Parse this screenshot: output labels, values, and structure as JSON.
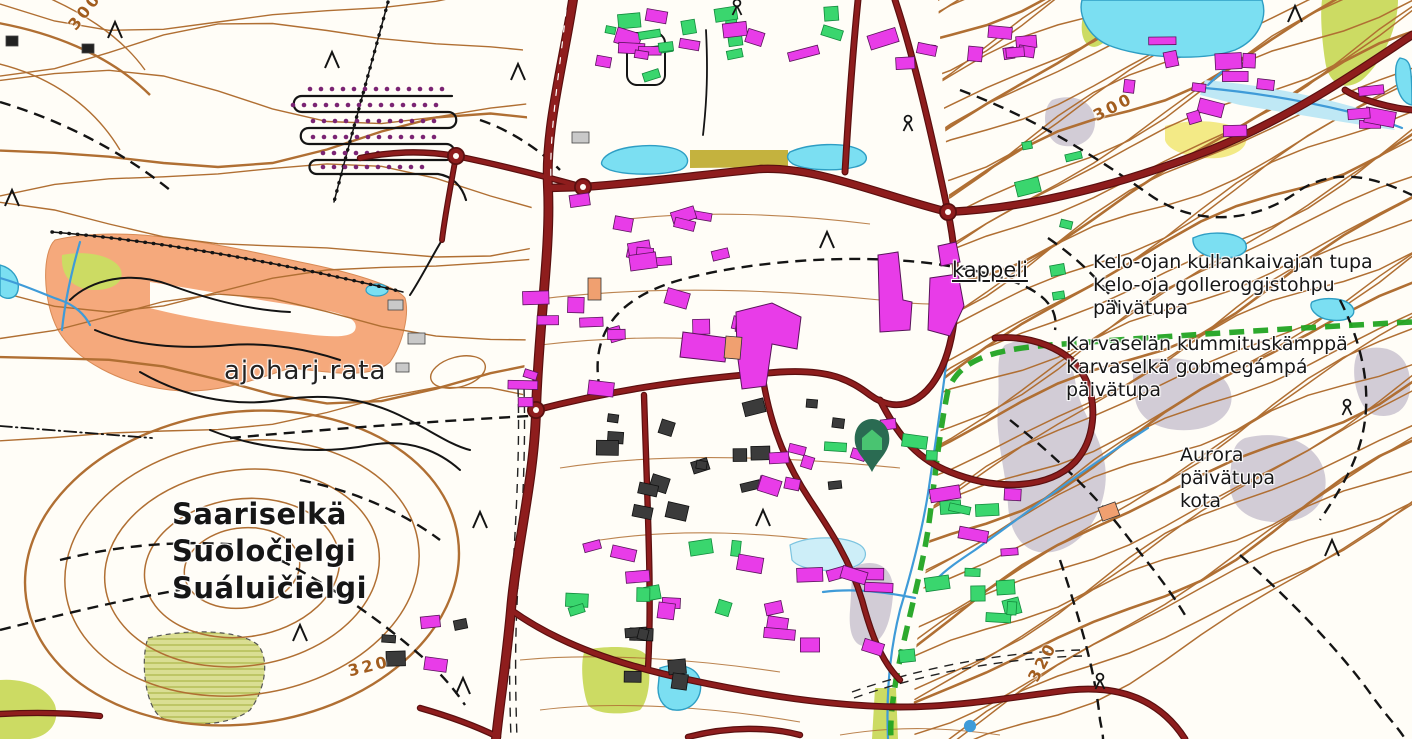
{
  "title": "Topographic map – Saariselkä",
  "place_name": {
    "line1": "Saariselkä",
    "line2": "Suoločielgi",
    "line3": "Suáluičielgi"
  },
  "labels": {
    "driving_track": "ajoharj.rata",
    "chapel": "kappeli",
    "kelo_oja_hut": {
      "line1": "Kelo-ojan kullankaivajan tupa",
      "line2": "Kelo-oja golleroggistohpu",
      "line3": "päivätupa"
    },
    "karvaselka_hut": {
      "line1": "Karvaselän kummituskämppä",
      "line2": "Karvaselkä gobmegámpá",
      "line3": "päivätupa"
    },
    "aurora_hut": {
      "line1": "Aurora",
      "line2": "päivätupa",
      "line3": "kota"
    }
  },
  "contour_labels": {
    "nw": "300",
    "ne": "300",
    "sw": "320",
    "se": "320"
  },
  "marker": {
    "name": "selected-location",
    "style": "pin-with-home-icon"
  },
  "colors": {
    "road": "#8e1d1d",
    "road_casing": "#5a0f0f",
    "contour": "#b06f33",
    "water_fill": "#7bdff2",
    "water_stroke": "#2e9ec4",
    "stream": "#3f9bd8",
    "building_magenta": "#e83ce8",
    "building_green": "#3ad66e",
    "building_dark": "#3b3b3b",
    "building_orange": "#f0a070",
    "track_area": "#f5a97c",
    "field": "#ccdb63",
    "field_dark": "#c4b23e",
    "yellow_patch": "#f3ea86",
    "scree": "#cdc6d2",
    "marsh": "#dade93",
    "trail_green": "#22a422",
    "path_black": "#141414",
    "pin_body": "#2a6b52",
    "pin_house": "#49c471",
    "label_text": "#161616",
    "contour_label": "#a25d1e"
  }
}
